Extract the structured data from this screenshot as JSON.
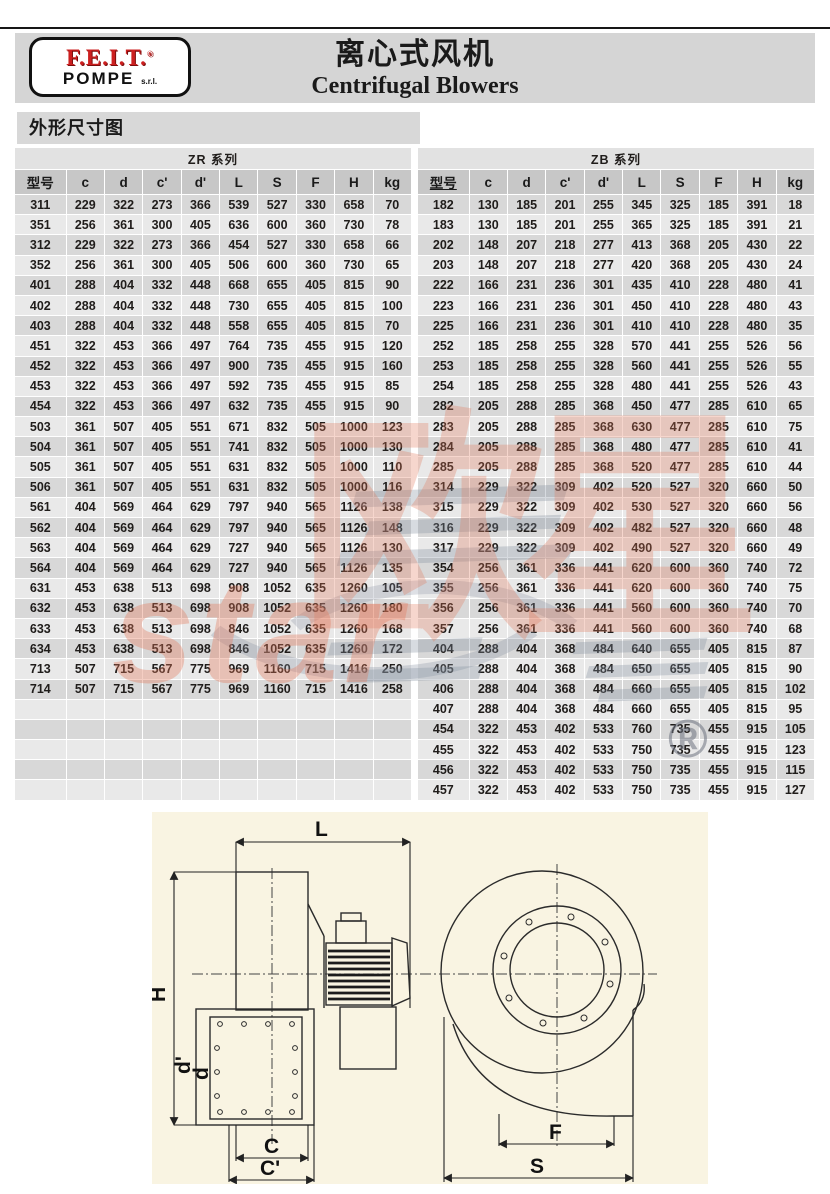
{
  "page": {
    "title_cn": "离心式风机",
    "title_en": "Centrifugal Blowers",
    "section_label": "外形尺寸图"
  },
  "logo": {
    "brand": "F.E.I.T.",
    "registered": "®",
    "sub": "POMPE",
    "suffix": "s.r.l."
  },
  "colors": {
    "band": "#d5d5d5",
    "bar": "#d8d8d8",
    "title-row": "#e2e2e2",
    "head": "#c7c7c7",
    "row-a": "#d8d8d8",
    "row-b": "#e9e9e9",
    "red": "#cc1f1f",
    "cream": "#f9f4e2"
  },
  "tables": [
    {
      "series": "ZR 系列",
      "columns": [
        "型号",
        "c",
        "d",
        "c'",
        "d'",
        "L",
        "S",
        "F",
        "H",
        "kg"
      ],
      "model_header_underline": false,
      "empty_rows": 5,
      "rows": [
        [
          "311",
          229,
          322,
          273,
          366,
          539,
          527,
          330,
          658,
          70
        ],
        [
          "351",
          256,
          361,
          300,
          405,
          636,
          600,
          360,
          730,
          78
        ],
        [
          "312",
          229,
          322,
          273,
          366,
          454,
          527,
          330,
          658,
          66
        ],
        [
          "352",
          256,
          361,
          300,
          405,
          506,
          600,
          360,
          730,
          65
        ],
        [
          "401",
          288,
          404,
          332,
          448,
          668,
          655,
          405,
          815,
          90
        ],
        [
          "402",
          288,
          404,
          332,
          448,
          730,
          655,
          405,
          815,
          100
        ],
        [
          "403",
          288,
          404,
          332,
          448,
          558,
          655,
          405,
          815,
          70
        ],
        [
          "451",
          322,
          453,
          366,
          497,
          764,
          735,
          455,
          915,
          120
        ],
        [
          "452",
          322,
          453,
          366,
          497,
          900,
          735,
          455,
          915,
          160
        ],
        [
          "453",
          322,
          453,
          366,
          497,
          592,
          735,
          455,
          915,
          85
        ],
        [
          "454",
          322,
          453,
          366,
          497,
          632,
          735,
          455,
          915,
          90
        ],
        [
          "503",
          361,
          507,
          405,
          551,
          671,
          832,
          505,
          1000,
          123
        ],
        [
          "504",
          361,
          507,
          405,
          551,
          741,
          832,
          505,
          1000,
          130
        ],
        [
          "505",
          361,
          507,
          405,
          551,
          631,
          832,
          505,
          1000,
          110
        ],
        [
          "506",
          361,
          507,
          405,
          551,
          631,
          832,
          505,
          1000,
          116
        ],
        [
          "561",
          404,
          569,
          464,
          629,
          797,
          940,
          565,
          1126,
          138
        ],
        [
          "562",
          404,
          569,
          464,
          629,
          797,
          940,
          565,
          1126,
          148
        ],
        [
          "563",
          404,
          569,
          464,
          629,
          727,
          940,
          565,
          1126,
          130
        ],
        [
          "564",
          404,
          569,
          464,
          629,
          727,
          940,
          565,
          1126,
          135
        ],
        [
          "631",
          453,
          638,
          513,
          698,
          908,
          1052,
          635,
          1260,
          105
        ],
        [
          "632",
          453,
          638,
          513,
          698,
          908,
          1052,
          635,
          1260,
          180
        ],
        [
          "633",
          453,
          638,
          513,
          698,
          846,
          1052,
          635,
          1260,
          168
        ],
        [
          "634",
          453,
          638,
          513,
          698,
          846,
          1052,
          635,
          1260,
          172
        ],
        [
          "713",
          507,
          715,
          567,
          775,
          969,
          1160,
          715,
          1416,
          250
        ],
        [
          "714",
          507,
          715,
          567,
          775,
          969,
          1160,
          715,
          1416,
          258
        ]
      ]
    },
    {
      "series": "ZB 系列",
      "columns": [
        "型号",
        "c",
        "d",
        "c'",
        "d'",
        "L",
        "S",
        "F",
        "H",
        "kg"
      ],
      "model_header_underline": true,
      "empty_rows": 0,
      "rows": [
        [
          "182",
          130,
          185,
          201,
          255,
          345,
          325,
          185,
          391,
          18
        ],
        [
          "183",
          130,
          185,
          201,
          255,
          365,
          325,
          185,
          391,
          21
        ],
        [
          "202",
          148,
          207,
          218,
          277,
          413,
          368,
          205,
          430,
          22
        ],
        [
          "203",
          148,
          207,
          218,
          277,
          420,
          368,
          205,
          430,
          24
        ],
        [
          "222",
          166,
          231,
          236,
          301,
          435,
          410,
          228,
          480,
          41
        ],
        [
          "223",
          166,
          231,
          236,
          301,
          450,
          410,
          228,
          480,
          43
        ],
        [
          "225",
          166,
          231,
          236,
          301,
          410,
          410,
          228,
          480,
          35
        ],
        [
          "252",
          185,
          258,
          255,
          328,
          570,
          441,
          255,
          526,
          56
        ],
        [
          "253",
          185,
          258,
          255,
          328,
          560,
          441,
          255,
          526,
          55
        ],
        [
          "254",
          185,
          258,
          255,
          328,
          480,
          441,
          255,
          526,
          43
        ],
        [
          "282",
          205,
          288,
          285,
          368,
          450,
          477,
          285,
          610,
          65
        ],
        [
          "283",
          205,
          288,
          285,
          368,
          630,
          477,
          285,
          610,
          75
        ],
        [
          "284",
          205,
          288,
          285,
          368,
          480,
          477,
          285,
          610,
          41
        ],
        [
          "285",
          205,
          288,
          285,
          368,
          520,
          477,
          285,
          610,
          44
        ],
        [
          "314",
          229,
          322,
          309,
          402,
          520,
          527,
          320,
          660,
          50
        ],
        [
          "315",
          229,
          322,
          309,
          402,
          530,
          527,
          320,
          660,
          56
        ],
        [
          "316",
          229,
          322,
          309,
          402,
          482,
          527,
          320,
          660,
          48
        ],
        [
          "317",
          229,
          322,
          309,
          402,
          490,
          527,
          320,
          660,
          49
        ],
        [
          "354",
          256,
          361,
          336,
          441,
          620,
          600,
          360,
          740,
          72
        ],
        [
          "355",
          256,
          361,
          336,
          441,
          620,
          600,
          360,
          740,
          75
        ],
        [
          "356",
          256,
          361,
          336,
          441,
          560,
          600,
          360,
          740,
          70
        ],
        [
          "357",
          256,
          361,
          336,
          441,
          560,
          600,
          360,
          740,
          68
        ],
        [
          "404",
          288,
          404,
          368,
          484,
          640,
          655,
          405,
          815,
          87
        ],
        [
          "405",
          288,
          404,
          368,
          484,
          650,
          655,
          405,
          815,
          90
        ],
        [
          "406",
          288,
          404,
          368,
          484,
          660,
          655,
          405,
          815,
          102
        ],
        [
          "407",
          288,
          404,
          368,
          484,
          660,
          655,
          405,
          815,
          95
        ],
        [
          "454",
          322,
          453,
          402,
          533,
          760,
          735,
          455,
          915,
          105
        ],
        [
          "455",
          322,
          453,
          402,
          533,
          750,
          735,
          455,
          915,
          123
        ],
        [
          "456",
          322,
          453,
          402,
          533,
          750,
          735,
          455,
          915,
          115
        ],
        [
          "457",
          322,
          453,
          402,
          533,
          750,
          735,
          455,
          915,
          127
        ]
      ]
    }
  ],
  "diagram": {
    "labels": {
      "length": "L",
      "height": "H",
      "flange_outer": "d'",
      "flange_inner": "d",
      "outlet_width": "C",
      "outlet_outer_width": "C'",
      "front_width": "F",
      "base_width": "S"
    }
  },
  "watermark": {
    "cn": "欧星",
    "en": "star",
    "registered": "®"
  }
}
